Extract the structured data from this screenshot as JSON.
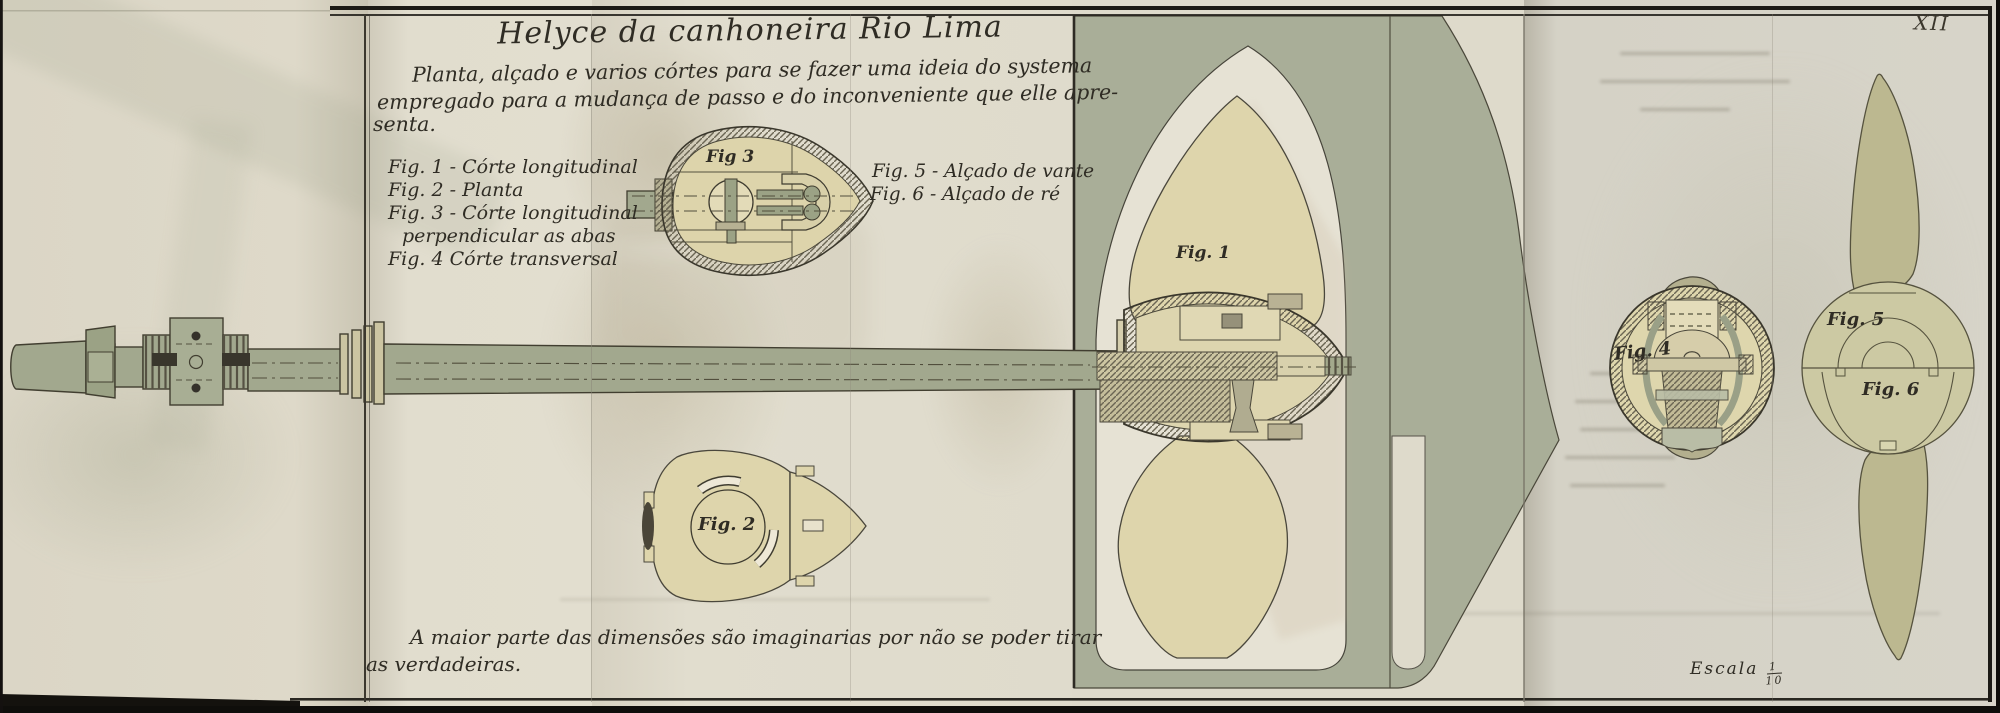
{
  "plate": {
    "number": "XII",
    "scale_label": "Escala",
    "scale_numerator": "1",
    "scale_denominator": "10"
  },
  "header": {
    "title": "Helyce da canhoneira Rio Lima",
    "subtitle_lines": [
      "Planta, alçado e varios córtes para se fazer uma ideia do systema",
      "empregado para a mudança de passo e do inconveniente que elle apre-",
      "senta."
    ]
  },
  "legend": {
    "items": [
      "Fig. 1 - Córte longitudinal",
      "Fig. 2 - Planta",
      "Fig. 3 - Córte longitudinal",
      "perpendicular as abas",
      "Fig. 4  Córte transversal"
    ],
    "right_items": [
      "Fig. 5 - Alçado de vante",
      "Fig. 6 - Alçado de ré"
    ]
  },
  "figures": {
    "fig1": "Fig. 1",
    "fig2": "Fig. 2",
    "fig3": "Fig 3",
    "fig4": "Fig. 4",
    "fig5": "Fig. 5",
    "fig6": "Fig. 6"
  },
  "footnote_lines": [
    "A maior parte das dimensões são imaginarias por não se poder tirar",
    "as verdadeiras."
  ],
  "colors": {
    "paper": "#dedacb",
    "sage_panel": "#a9ae98",
    "sage_metal": "#a2a88e",
    "tan_blade": "#ded5ac",
    "olive_disc": "#ccc9a3",
    "olive_blade": "#bcb890",
    "ink": "#2f2c24"
  }
}
